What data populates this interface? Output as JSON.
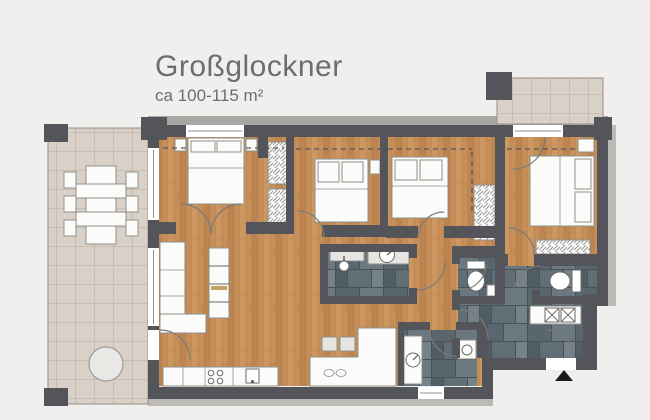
{
  "header": {
    "title": "Großglockner",
    "subtitle": "ca 100-115 m²"
  },
  "floorplan": {
    "type": "apartment-floor-plan",
    "areas": [
      "terrace",
      "living-kitchen",
      "bedroom-1",
      "bedroom-2",
      "bedroom-3",
      "bedroom-4",
      "bathroom",
      "wc-1",
      "wc-2",
      "shower-room",
      "hallway",
      "balcony"
    ],
    "fixtures": [
      "dining-table",
      "round-table",
      "double-bed",
      "wardrobe",
      "sofa",
      "shelf-unit",
      "kitchen-counter",
      "stove",
      "kitchen-sink",
      "bar-counter",
      "bar-stools",
      "washbasin",
      "shower",
      "toilet",
      "washing-machine",
      "radiator",
      "entrance-arrow"
    ]
  },
  "colors": {
    "background": "#f0efed",
    "wall": "#54555a",
    "wood": "#c68e58",
    "wood_line": "#a97944",
    "terrace": "#d9d1c8",
    "terrace_line": "#b7ac9f",
    "slate_grout": "#47525a",
    "white": "#fbfbf9",
    "stroke": "#8f8f8c",
    "title": "#6d6d6d",
    "accent": "#c9a063",
    "arc": "#7b7b76",
    "dash": "#55565a",
    "eave": "#a8a7a4",
    "shadow": "#bbbab7",
    "entrance": "#1a1a1a"
  }
}
